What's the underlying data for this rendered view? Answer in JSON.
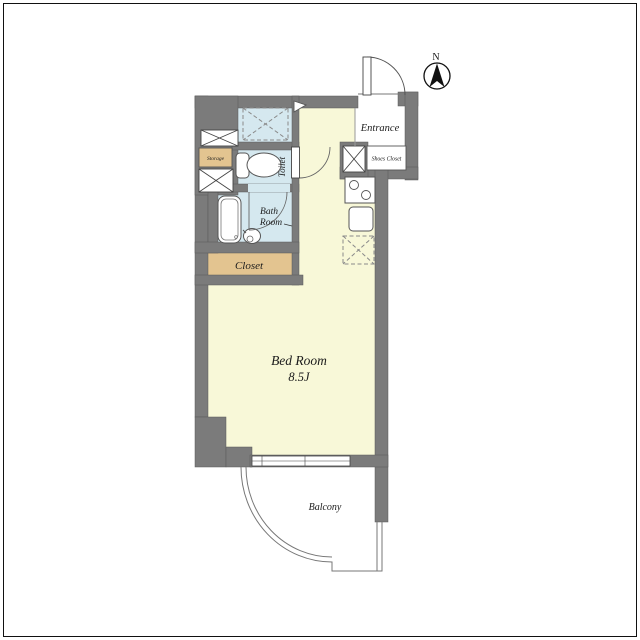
{
  "plan": {
    "compass": {
      "label": "N"
    },
    "rooms": {
      "entrance": {
        "label": "Entrance"
      },
      "shoes_closet": {
        "label": "Shoes Closet"
      },
      "storage": {
        "label": "Storage"
      },
      "toilet": {
        "label": "Toilet"
      },
      "bath_room": {
        "line1": "Bath",
        "line2": "Room"
      },
      "closet": {
        "label": "Closet"
      },
      "bed_room": {
        "label": "Bed Room",
        "size": "8.5J"
      },
      "balcony": {
        "label": "Balcony"
      }
    },
    "colors": {
      "wall": "#7B7B7B",
      "floor_main": "#F8F8D8",
      "floor_wet": "#D5E8EF",
      "closet_fill": "#E3C490",
      "line": "#555555"
    }
  }
}
